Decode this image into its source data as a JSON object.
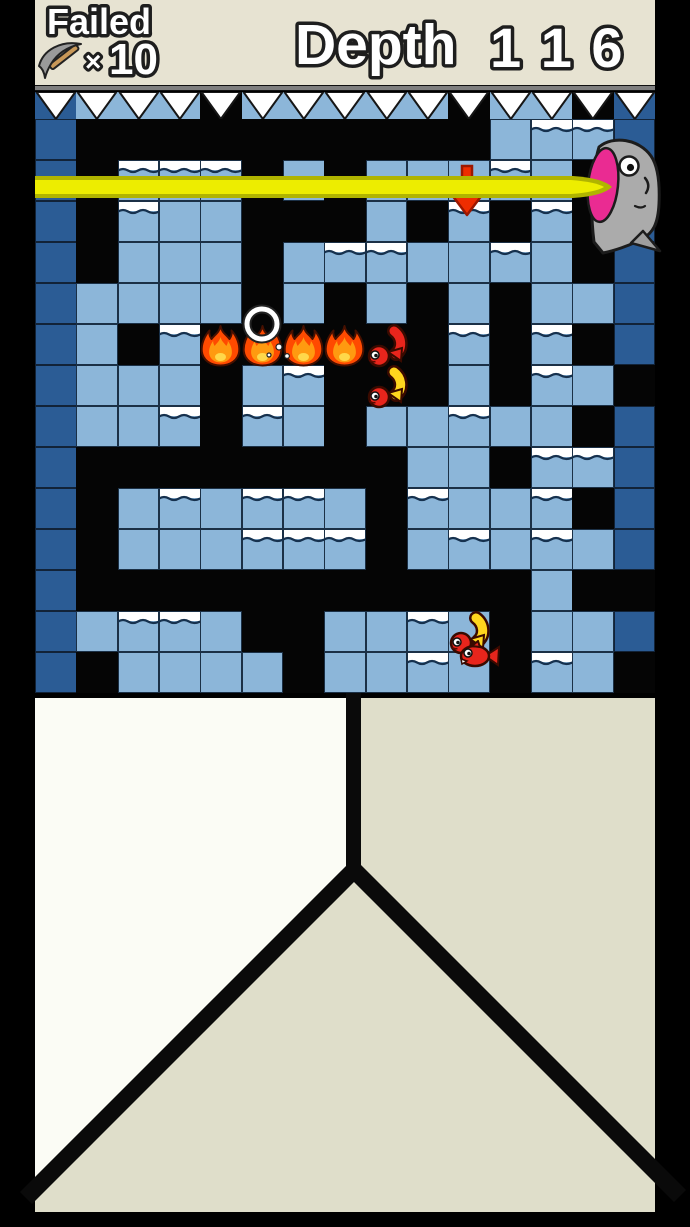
{
  "header": {
    "failed_label": "Failed",
    "times_symbol": "×",
    "failed_count": "10",
    "depth_label": "Depth",
    "depth_digits": "1 1 6"
  },
  "colors": {
    "bg": "#000000",
    "panel": "#e7e3d2",
    "dark_tile": "#2b5c95",
    "light_tile": "#8cb6d9",
    "spike_rail": "#7f7f7f",
    "spike_fill": "#ffffff",
    "laser_core": "#eded00",
    "laser_edge": "#b0b400",
    "arrow_red": "#ee2d00",
    "fire_orange": "#ff4a00",
    "fish_red": "#e8251c",
    "fish_yellow": "#ffd61e",
    "head_gray": "#ababab",
    "mouth_pink": "#ea2b92",
    "cave_left_white": "#fbfcf5",
    "cave_right_beige": "#dfdeca"
  },
  "grid": {
    "cols": 15,
    "rows": [
      "DBBBBBBBBBBLWWD",
      "DBWWWBLBLLLWLBD",
      "DBWLLBBBLBWBWBD",
      "DBLLLBLWWLLWLBD",
      "DLLLLBLBLBLBLLD",
      "DLBWBBBBBBWBWBD",
      "DLLLBLWBBBLBWLB",
      "DLLWBWLBLLWLLBD",
      "DBBBBBBBBLLBWWD",
      "DBLWLWWLBWLLWBD",
      "DBLLLWWWBLWLWLD",
      "DBBBBBBBBBBBLBB",
      "DLWWLBBLLWLBLLD",
      "DBLLLLBLLWLBWLB"
    ],
    "tile_w": 41.333,
    "tile_h": 41,
    "origin_x": 35,
    "origin_y": 119,
    "legend": {
      "D": "dark-edge-tile",
      "L": "light-water-tile",
      "W": "light-tile-with-surface-wave",
      "B": "dug-empty-black"
    },
    "spike_row": "DLLLBLLLLLBLLBD"
  },
  "sprites": {
    "fires": [
      {
        "col": 4,
        "row": 5
      },
      {
        "col": 5,
        "row": 5
      },
      {
        "col": 6,
        "row": 5
      },
      {
        "col": 7,
        "row": 5
      }
    ],
    "fishes": [
      {
        "type": "curl",
        "variant": "red",
        "col": 8,
        "row": 5
      },
      {
        "type": "curl",
        "variant": "yellow",
        "col": 8,
        "row": 6
      },
      {
        "type": "curl",
        "variant": "yellow",
        "col": 10,
        "row": 12
      },
      {
        "type": "small",
        "variant": "red",
        "x": 456,
        "y": 640
      }
    ],
    "ring": {
      "x": 262,
      "y": 324,
      "r": 15
    },
    "arrow": {
      "x": 449,
      "y": 164
    },
    "laser": {
      "x": 35,
      "y": 175,
      "length": 578,
      "height": 24
    },
    "fish_head": {
      "x": 565,
      "y": 130
    }
  },
  "cave": {
    "fork_x": 354,
    "fork_y": 871,
    "line_top": 693,
    "line_width": 16
  }
}
